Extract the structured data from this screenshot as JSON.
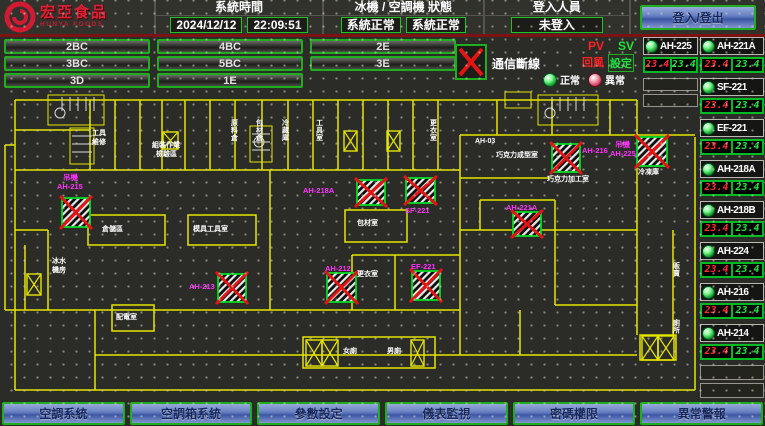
{
  "header": {
    "logo": {
      "title": "宏亞食品",
      "subtitle": "HUNYA FOODS"
    },
    "sections": [
      {
        "label": "系統時間",
        "values": [
          "2024/12/12",
          "22:09:51"
        ]
      },
      {
        "label": "冰機 / 空調機 狀態",
        "values": [
          "系統正常",
          "系統正常"
        ]
      },
      {
        "label": "登入人員",
        "values": [
          "未登入"
        ]
      }
    ],
    "login_button": "登入/登出"
  },
  "zones": {
    "rows": [
      [
        "2BC",
        "4BC",
        "2E"
      ],
      [
        "3BC",
        "5BC",
        "3E"
      ],
      [
        "3D",
        "1E"
      ]
    ]
  },
  "legend": {
    "comm_fail": "通信斷線",
    "pv": "PV",
    "sv": "SV",
    "pv_desc": "回風",
    "sv_desc": "設定",
    "normal": "正常",
    "abnormal": "異常"
  },
  "panel": {
    "left_units": [
      {
        "name": "AH-225",
        "pv": "23.4",
        "sv": "23.4",
        "status": "normal"
      }
    ],
    "left_empty": 2,
    "right_units": [
      {
        "name": "AH-221A",
        "pv": "23.4",
        "sv": "23.4",
        "status": "normal"
      },
      {
        "name": "SF-221",
        "pv": "23.4",
        "sv": "23.4",
        "status": "normal"
      },
      {
        "name": "EF-221",
        "pv": "23.4",
        "sv": "23.4",
        "status": "normal"
      },
      {
        "name": "AH-218A",
        "pv": "23.4",
        "sv": "23.4",
        "status": "normal"
      },
      {
        "name": "AH-218B",
        "pv": "23.4",
        "sv": "23.4",
        "status": "normal"
      },
      {
        "name": "AH-224",
        "pv": "23.4",
        "sv": "23.4",
        "status": "normal"
      },
      {
        "name": "AH-216",
        "pv": "23.4",
        "sv": "23.4",
        "status": "normal"
      },
      {
        "name": "AH-214",
        "pv": "23.4",
        "sv": "23.4",
        "status": "normal"
      }
    ],
    "right_empty": 2
  },
  "floorplan": {
    "comm_fail_markers": [
      {
        "x": 62,
        "y": 198,
        "w": 28,
        "h": 29
      },
      {
        "x": 357,
        "y": 180,
        "w": 28,
        "h": 25
      },
      {
        "x": 406,
        "y": 178,
        "w": 29,
        "h": 25
      },
      {
        "x": 513,
        "y": 212,
        "w": 28,
        "h": 24
      },
      {
        "x": 552,
        "y": 144,
        "w": 28,
        "h": 28
      },
      {
        "x": 637,
        "y": 137,
        "w": 30,
        "h": 29
      },
      {
        "x": 218,
        "y": 274,
        "w": 28,
        "h": 28
      },
      {
        "x": 327,
        "y": 273,
        "w": 29,
        "h": 29
      },
      {
        "x": 412,
        "y": 271,
        "w": 28,
        "h": 29
      }
    ],
    "shaft_boxes": [
      {
        "x": 163,
        "y": 132,
        "w": 15,
        "h": 17
      },
      {
        "x": 344,
        "y": 131,
        "w": 13,
        "h": 20
      },
      {
        "x": 387,
        "y": 131,
        "w": 13,
        "h": 20
      },
      {
        "x": 27,
        "y": 274,
        "w": 14,
        "h": 21
      },
      {
        "x": 306,
        "y": 340,
        "w": 16,
        "h": 26
      },
      {
        "x": 322,
        "y": 340,
        "w": 16,
        "h": 26
      },
      {
        "x": 411,
        "y": 340,
        "w": 13,
        "h": 26
      },
      {
        "x": 642,
        "y": 336,
        "w": 16,
        "h": 24
      },
      {
        "x": 658,
        "y": 336,
        "w": 16,
        "h": 24
      }
    ],
    "labels": [
      {
        "t": "吊機",
        "x": 63,
        "y": 180,
        "c": "m"
      },
      {
        "t": "AH-215",
        "x": 57,
        "y": 189,
        "c": "m"
      },
      {
        "t": "AH-218A",
        "x": 303,
        "y": 193,
        "c": "m"
      },
      {
        "t": "SF-221",
        "x": 405,
        "y": 213,
        "c": "m"
      },
      {
        "t": "AH-221A",
        "x": 506,
        "y": 210,
        "c": "m"
      },
      {
        "t": "AH-216",
        "x": 582,
        "y": 153,
        "c": "m"
      },
      {
        "t": "吊機",
        "x": 615,
        "y": 147,
        "c": "m"
      },
      {
        "t": "AH-225",
        "x": 610,
        "y": 156,
        "c": "m"
      },
      {
        "t": "AH-213",
        "x": 189,
        "y": 289,
        "c": "m"
      },
      {
        "t": "AH-212",
        "x": 325,
        "y": 271,
        "c": "m"
      },
      {
        "t": "EF-221",
        "x": 411,
        "y": 269,
        "c": "m"
      },
      {
        "t": "工具",
        "x": 92,
        "y": 135,
        "c": "w"
      },
      {
        "t": "維修",
        "x": 92,
        "y": 144,
        "c": "w"
      },
      {
        "t": "組裝作業",
        "x": 152,
        "y": 147,
        "c": "w"
      },
      {
        "t": "檢驗區",
        "x": 156,
        "y": 156,
        "c": "w"
      },
      {
        "t": "AH-03",
        "x": 475,
        "y": 143,
        "c": "w"
      },
      {
        "t": "巧克力成型室",
        "x": 496,
        "y": 157,
        "c": "w"
      },
      {
        "t": "巧克力加工室",
        "x": 547,
        "y": 181,
        "c": "w"
      },
      {
        "t": "冷凍庫",
        "x": 638,
        "y": 174,
        "c": "w"
      },
      {
        "t": "包材室",
        "x": 357,
        "y": 225,
        "c": "w"
      },
      {
        "t": "更衣室",
        "x": 357,
        "y": 276,
        "c": "w"
      },
      {
        "t": "倉儲區",
        "x": 102,
        "y": 231,
        "c": "w"
      },
      {
        "t": "模具工具室",
        "x": 193,
        "y": 231,
        "c": "w"
      },
      {
        "t": "配電室",
        "x": 116,
        "y": 319,
        "c": "w"
      },
      {
        "t": "女廁",
        "x": 343,
        "y": 353,
        "c": "w"
      },
      {
        "t": "男廁",
        "x": 387,
        "y": 353,
        "c": "w"
      },
      {
        "t": "冰水",
        "x": 52,
        "y": 263,
        "c": "w"
      },
      {
        "t": "機房",
        "x": 52,
        "y": 272,
        "c": "w"
      },
      {
        "t": "原料倉",
        "x": 231,
        "y": 125,
        "c": "w",
        "v": true
      },
      {
        "t": "包材倉",
        "x": 256,
        "y": 125,
        "c": "w",
        "v": true
      },
      {
        "t": "冷藏庫",
        "x": 282,
        "y": 125,
        "c": "w",
        "v": true
      },
      {
        "t": "工具室",
        "x": 316,
        "y": 125,
        "c": "w",
        "v": true
      },
      {
        "t": "更衣室",
        "x": 430,
        "y": 125,
        "c": "w",
        "v": true
      },
      {
        "t": "販賣",
        "x": 673,
        "y": 268,
        "c": "w",
        "v": true
      },
      {
        "t": "廁所",
        "x": 673,
        "y": 325,
        "c": "w",
        "v": true
      }
    ]
  },
  "nav": {
    "items": [
      "空調系統",
      "空調箱系統",
      "參數設定",
      "儀表監視",
      "密碼權限",
      "異常警報"
    ]
  },
  "colors": {
    "accent_green": "#1eae1e",
    "alarm_red": "#e31414",
    "magenta": "#ff33ff",
    "plan_yellow": "#e6e600",
    "button_blue": "#5570b8",
    "pv_red": "#ff2a2a",
    "sv_green": "#1ee53e"
  }
}
